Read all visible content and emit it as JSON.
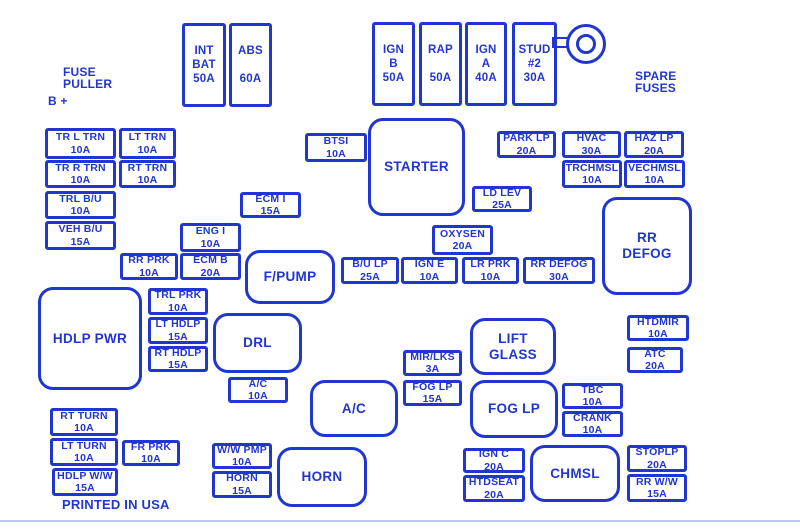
{
  "diagram": {
    "colors": {
      "ink": "#2135d1",
      "background": "#ffffff",
      "bottom_rule": "#bcc8ea"
    },
    "annotations": [
      {
        "id": "fuse-puller-label",
        "lines": [
          "FUSE",
          "PULLER"
        ],
        "x": 63,
        "y": 66,
        "size": 12
      },
      {
        "id": "b-plus-label",
        "lines": [
          "B +"
        ],
        "x": 48,
        "y": 95,
        "size": 12
      },
      {
        "id": "spare-fuses-label",
        "lines": [
          "SPARE",
          "FUSES"
        ],
        "x": 635,
        "y": 70,
        "size": 12
      },
      {
        "id": "printed-in-usa-label",
        "lines": [
          "PRINTED IN USA"
        ],
        "x": 62,
        "y": 498,
        "size": 13
      }
    ],
    "tall_fuses": [
      {
        "id": "int-bat",
        "lines": [
          "INT",
          "BAT",
          "50A"
        ],
        "x": 182,
        "y": 23,
        "w": 44,
        "h": 84
      },
      {
        "id": "abs",
        "lines": [
          "ABS",
          "",
          "60A"
        ],
        "x": 229,
        "y": 23,
        "w": 43,
        "h": 84
      },
      {
        "id": "ign-b",
        "lines": [
          "IGN",
          "B",
          "50A"
        ],
        "x": 372,
        "y": 22,
        "w": 43,
        "h": 84
      },
      {
        "id": "rap",
        "lines": [
          "RAP",
          "",
          "50A"
        ],
        "x": 419,
        "y": 22,
        "w": 43,
        "h": 84
      },
      {
        "id": "ign-a",
        "lines": [
          "IGN",
          "A",
          "40A"
        ],
        "x": 465,
        "y": 22,
        "w": 42,
        "h": 84
      },
      {
        "id": "stud-2",
        "lines": [
          "STUD",
          "#2",
          "30A"
        ],
        "x": 512,
        "y": 22,
        "w": 45,
        "h": 84
      }
    ],
    "fuses": [
      {
        "id": "tr-l-trn",
        "lines": [
          "TR L TRN",
          "10A"
        ],
        "x": 45,
        "y": 128,
        "w": 71,
        "h": 31
      },
      {
        "id": "lt-trn",
        "lines": [
          "LT TRN",
          "10A"
        ],
        "x": 119,
        "y": 128,
        "w": 57,
        "h": 31
      },
      {
        "id": "tr-r-trn",
        "lines": [
          "TR R TRN",
          "10A"
        ],
        "x": 45,
        "y": 160,
        "w": 71,
        "h": 28
      },
      {
        "id": "rt-trn",
        "lines": [
          "RT TRN",
          "10A"
        ],
        "x": 119,
        "y": 160,
        "w": 57,
        "h": 28
      },
      {
        "id": "trl-bu",
        "lines": [
          "TRL B/U",
          "10A"
        ],
        "x": 45,
        "y": 191,
        "w": 71,
        "h": 28
      },
      {
        "id": "veh-bu",
        "lines": [
          "VEH B/U",
          "15A"
        ],
        "x": 45,
        "y": 221,
        "w": 71,
        "h": 29
      },
      {
        "id": "btsi",
        "lines": [
          "BTSI",
          "10A"
        ],
        "x": 305,
        "y": 133,
        "w": 62,
        "h": 29
      },
      {
        "id": "park-lp",
        "lines": [
          "PARK LP",
          "20A"
        ],
        "x": 497,
        "y": 131,
        "w": 59,
        "h": 27
      },
      {
        "id": "hvac",
        "lines": [
          "HVAC",
          "30A"
        ],
        "x": 562,
        "y": 131,
        "w": 59,
        "h": 27
      },
      {
        "id": "haz-lp",
        "lines": [
          "HAZ LP",
          "20A"
        ],
        "x": 624,
        "y": 131,
        "w": 60,
        "h": 27
      },
      {
        "id": "trchmsl",
        "lines": [
          "TRCHMSL",
          "10A"
        ],
        "x": 562,
        "y": 160,
        "w": 60,
        "h": 28
      },
      {
        "id": "vechmsl",
        "lines": [
          "VECHMSL",
          "10A"
        ],
        "x": 624,
        "y": 160,
        "w": 61,
        "h": 28
      },
      {
        "id": "ld-lev",
        "lines": [
          "LD LEV",
          "25A"
        ],
        "x": 472,
        "y": 186,
        "w": 60,
        "h": 26
      },
      {
        "id": "ecm-i",
        "lines": [
          "ECM I",
          "15A"
        ],
        "x": 240,
        "y": 192,
        "w": 61,
        "h": 26
      },
      {
        "id": "eng-i",
        "lines": [
          "ENG I",
          "10A"
        ],
        "x": 180,
        "y": 223,
        "w": 61,
        "h": 29
      },
      {
        "id": "rr-prk",
        "lines": [
          "RR PRK",
          "10A"
        ],
        "x": 120,
        "y": 253,
        "w": 58,
        "h": 27
      },
      {
        "id": "ecm-b",
        "lines": [
          "ECM B",
          "20A"
        ],
        "x": 180,
        "y": 253,
        "w": 61,
        "h": 27
      },
      {
        "id": "oxysen",
        "lines": [
          "OXYSEN",
          "20A"
        ],
        "x": 432,
        "y": 225,
        "w": 61,
        "h": 30
      },
      {
        "id": "bu-lp",
        "lines": [
          "B/U LP",
          "25A"
        ],
        "x": 341,
        "y": 257,
        "w": 58,
        "h": 27
      },
      {
        "id": "ign-e",
        "lines": [
          "IGN E",
          "10A"
        ],
        "x": 401,
        "y": 257,
        "w": 57,
        "h": 27
      },
      {
        "id": "lr-prk",
        "lines": [
          "LR PRK",
          "10A"
        ],
        "x": 462,
        "y": 257,
        "w": 57,
        "h": 27
      },
      {
        "id": "rr-defog-fuse",
        "lines": [
          "RR DEFOG",
          "30A"
        ],
        "x": 523,
        "y": 257,
        "w": 72,
        "h": 27
      },
      {
        "id": "trl-prk",
        "lines": [
          "TRL PRK",
          "10A"
        ],
        "x": 148,
        "y": 288,
        "w": 60,
        "h": 27
      },
      {
        "id": "lt-hdlp",
        "lines": [
          "LT HDLP",
          "15A"
        ],
        "x": 148,
        "y": 317,
        "w": 60,
        "h": 27
      },
      {
        "id": "rt-hdlp",
        "lines": [
          "RT HDLP",
          "15A"
        ],
        "x": 148,
        "y": 346,
        "w": 60,
        "h": 26
      },
      {
        "id": "htdmir",
        "lines": [
          "HTDMIR",
          "10A"
        ],
        "x": 627,
        "y": 315,
        "w": 62,
        "h": 26
      },
      {
        "id": "atc",
        "lines": [
          "ATC",
          "20A"
        ],
        "x": 627,
        "y": 347,
        "w": 56,
        "h": 26
      },
      {
        "id": "mir-lks",
        "lines": [
          "MIR/LKS",
          "3A"
        ],
        "x": 403,
        "y": 350,
        "w": 59,
        "h": 26
      },
      {
        "id": "ac-fuse",
        "lines": [
          "A/C",
          "10A"
        ],
        "x": 228,
        "y": 377,
        "w": 60,
        "h": 26
      },
      {
        "id": "fog-lp-fuse",
        "lines": [
          "FOG LP",
          "15A"
        ],
        "x": 403,
        "y": 380,
        "w": 59,
        "h": 26
      },
      {
        "id": "tbc",
        "lines": [
          "TBC",
          "10A"
        ],
        "x": 562,
        "y": 383,
        "w": 61,
        "h": 26
      },
      {
        "id": "crank",
        "lines": [
          "CRANK",
          "10A"
        ],
        "x": 562,
        "y": 411,
        "w": 61,
        "h": 26
      },
      {
        "id": "rt-turn",
        "lines": [
          "RT TURN",
          "10A"
        ],
        "x": 50,
        "y": 408,
        "w": 68,
        "h": 28
      },
      {
        "id": "lt-turn",
        "lines": [
          "LT TURN",
          "10A"
        ],
        "x": 50,
        "y": 438,
        "w": 68,
        "h": 28
      },
      {
        "id": "fr-prk",
        "lines": [
          "FR PRK",
          "10A"
        ],
        "x": 122,
        "y": 440,
        "w": 58,
        "h": 26
      },
      {
        "id": "ww-pmp",
        "lines": [
          "W/W PMP",
          "10A"
        ],
        "x": 212,
        "y": 443,
        "w": 60,
        "h": 26
      },
      {
        "id": "hdlp-ww",
        "lines": [
          "HDLP W/W",
          "15A"
        ],
        "x": 52,
        "y": 468,
        "w": 66,
        "h": 28
      },
      {
        "id": "horn-fuse",
        "lines": [
          "HORN",
          "15A"
        ],
        "x": 212,
        "y": 471,
        "w": 60,
        "h": 27
      },
      {
        "id": "ign-c",
        "lines": [
          "IGN C",
          "20A"
        ],
        "x": 463,
        "y": 448,
        "w": 62,
        "h": 25
      },
      {
        "id": "htdseat",
        "lines": [
          "HTDSEAT",
          "20A"
        ],
        "x": 463,
        "y": 475,
        "w": 62,
        "h": 27
      },
      {
        "id": "stoplp",
        "lines": [
          "STOPLP",
          "20A"
        ],
        "x": 627,
        "y": 445,
        "w": 60,
        "h": 27
      },
      {
        "id": "rr-ww",
        "lines": [
          "RR W/W",
          "15A"
        ],
        "x": 627,
        "y": 474,
        "w": 60,
        "h": 28
      }
    ],
    "relays": [
      {
        "id": "starter",
        "lines": [
          "STARTER"
        ],
        "x": 368,
        "y": 118,
        "w": 97,
        "h": 98
      },
      {
        "id": "rr-defog",
        "lines": [
          "RR",
          "DEFOG"
        ],
        "x": 602,
        "y": 197,
        "w": 90,
        "h": 98
      },
      {
        "id": "f-pump",
        "lines": [
          "F/PUMP"
        ],
        "x": 245,
        "y": 250,
        "w": 90,
        "h": 54
      },
      {
        "id": "hdlp-pwr",
        "lines": [
          "HDLP PWR"
        ],
        "x": 38,
        "y": 287,
        "w": 104,
        "h": 103
      },
      {
        "id": "drl",
        "lines": [
          "DRL"
        ],
        "x": 213,
        "y": 313,
        "w": 89,
        "h": 60
      },
      {
        "id": "lift-glass",
        "lines": [
          "LIFT GLASS"
        ],
        "x": 470,
        "y": 318,
        "w": 86,
        "h": 57
      },
      {
        "id": "ac",
        "lines": [
          "A/C"
        ],
        "x": 310,
        "y": 380,
        "w": 88,
        "h": 57
      },
      {
        "id": "fog-lp",
        "lines": [
          "FOG LP"
        ],
        "x": 470,
        "y": 380,
        "w": 88,
        "h": 58
      },
      {
        "id": "horn",
        "lines": [
          "HORN"
        ],
        "x": 277,
        "y": 447,
        "w": 90,
        "h": 60
      },
      {
        "id": "chmsl",
        "lines": [
          "CHMSL"
        ],
        "x": 530,
        "y": 445,
        "w": 90,
        "h": 57
      }
    ]
  }
}
